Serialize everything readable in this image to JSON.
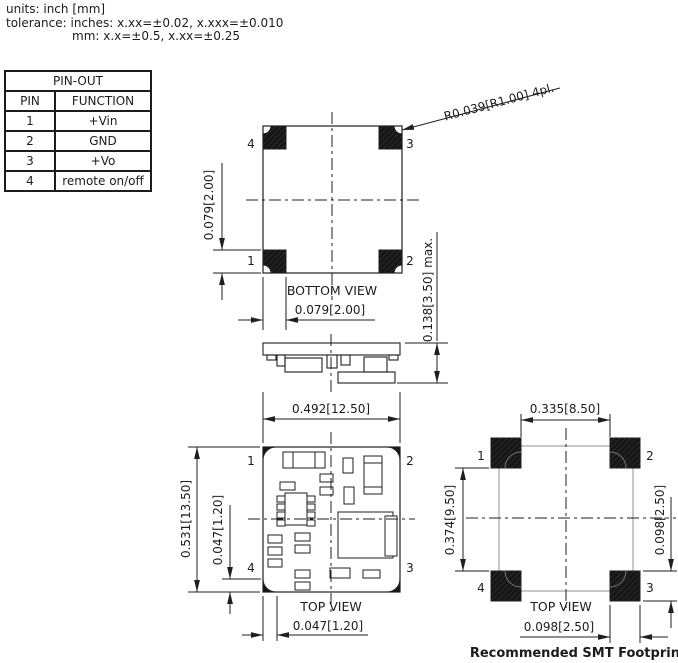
{
  "header": {
    "line1": "units: inch [mm]",
    "line2": "tolerance: inches: x.xx=±0.02, x.xxx=±0.010",
    "line3": "mm: x.x=±0.5, x.xx=±0.25"
  },
  "pinout_table": {
    "title": "PIN-OUT",
    "col_pin": "PIN",
    "col_function": "FUNCTION",
    "rows": [
      {
        "pin": "1",
        "function": "+Vin"
      },
      {
        "pin": "2",
        "function": "GND"
      },
      {
        "pin": "3",
        "function": "+Vo"
      },
      {
        "pin": "4",
        "function": "remote on/off"
      }
    ]
  },
  "bottom_view": {
    "label": "BOTTOM VIEW",
    "radius_callout": "R0.039[R1.00] 4pl.",
    "dim_pad_height": "0.079[2.00]",
    "dim_pad_width": "0.079[2.00]",
    "dim_max_height": "0.138[3.50] max.",
    "pins": {
      "tl": "4",
      "tr": "3",
      "bl": "1",
      "br": "2"
    }
  },
  "top_view": {
    "label": "TOP VIEW",
    "dim_width": "0.492[12.50]",
    "dim_height": "0.531[13.50]",
    "dim_pad_height": "0.047[1.20]",
    "dim_pad_width": "0.047[1.20]",
    "pins": {
      "tl": "1",
      "tr": "2",
      "bl": "4",
      "br": "3"
    }
  },
  "footprint": {
    "label": "TOP VIEW",
    "caption": "Recommended SMT Footprint",
    "dim_pad_span_x": "0.335[8.50]",
    "dim_pad_span_y": "0.374[9.50]",
    "dim_pad_height": "0.098[2.50]",
    "dim_pad_width": "0.098[2.50]",
    "pins": {
      "tl": "1",
      "tr": "2",
      "bl": "4",
      "br": "3"
    }
  },
  "colors": {
    "line": "#1f1f1f",
    "pad": "#161616",
    "overlay_box": "#909090"
  }
}
